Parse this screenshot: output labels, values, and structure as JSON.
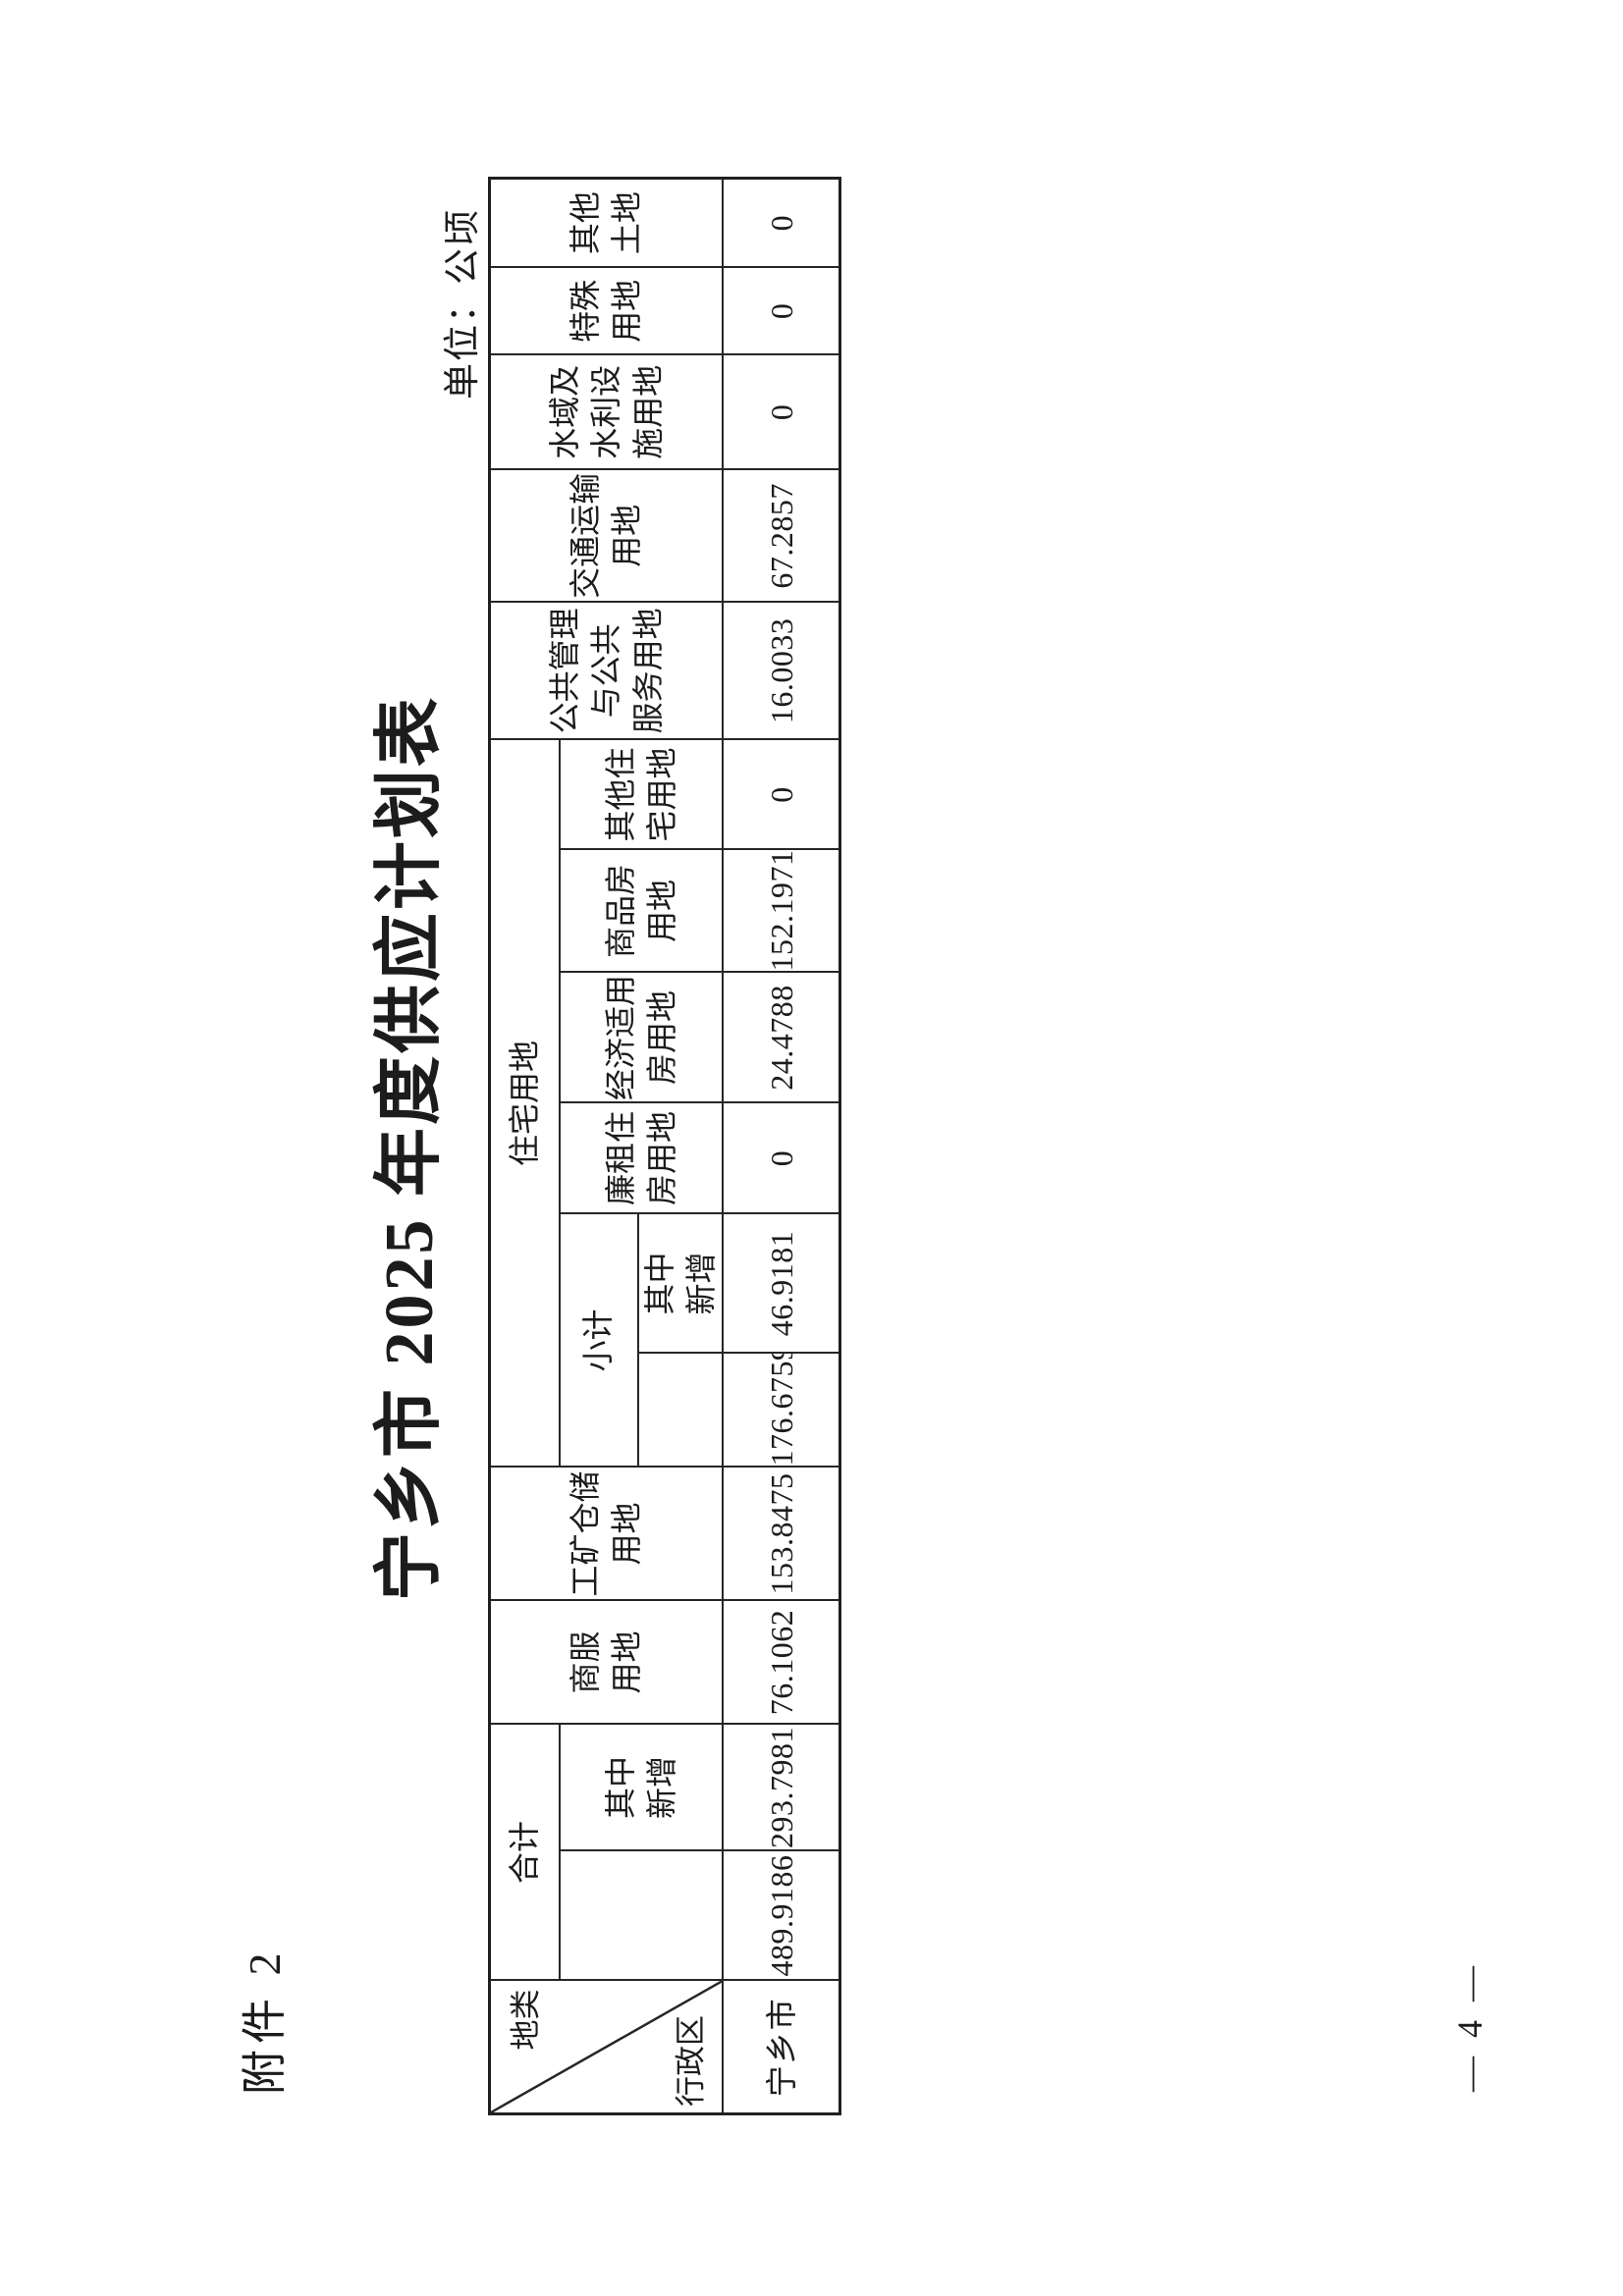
{
  "page": {
    "attachment": "附件 2",
    "title": "宁乡市 2025 年度供应计划表",
    "unit": "单位：公顷",
    "page_number": "— 4 —"
  },
  "table": {
    "corner_top": "地类",
    "corner_bottom": "行政区",
    "h_total": "合计",
    "h_total_new": "其中\n新增",
    "h_shangfu": "商服\n用地",
    "h_gongkuang": "工矿仓储\n用地",
    "h_zhuzhai": "住宅用地",
    "h_xiaoji": "小计",
    "h_xiaoji_new": "其中\n新增",
    "h_lianzu": "廉租住\n房用地",
    "h_jingshiyong": "经济适用\n房用地",
    "h_shangpin": "商品房\n用地",
    "h_qitazhuzhai": "其他住\n宅用地",
    "h_gonggong": "公共管理\n与公共\n服务用地",
    "h_jiaotong": "交通运输\n用地",
    "h_shuiyu": "水域及\n水利设\n施用地",
    "h_teshu": "特殊\n用地",
    "h_qitatudi": "其他\n土地",
    "row": {
      "region": "宁乡市",
      "total": "489.9186",
      "total_new": "293.7981",
      "shangfu": "76.1062",
      "gongkuang": "153.8475",
      "xiaoji": "176.6759",
      "xiaoji_new": "46.9181",
      "lianzu": "0",
      "jingshiyong": "24.4788",
      "shangpin": "152.1971",
      "qitazhuzhai": "0",
      "gonggong": "16.0033",
      "jiaotong": "67.2857",
      "shuiyu": "0",
      "teshu": "0",
      "qitatudi": "0"
    }
  }
}
